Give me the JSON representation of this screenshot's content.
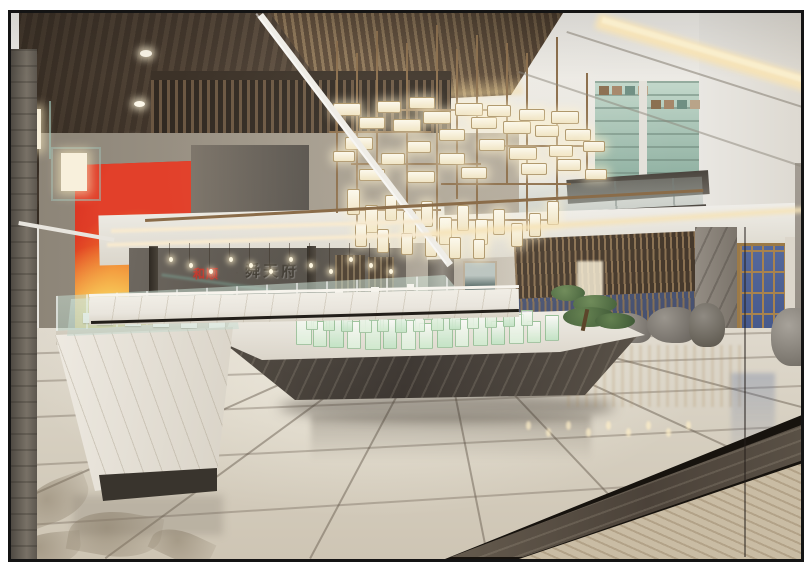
{
  "scene": {
    "type": "interior-architectural-rendering",
    "description": "Double-height real-estate sales center lobby: dark wood ceiling, brass box chandelier, balcony with moon-gate screen, stone reception wall, green glass scale model on a marble island, glass vitrines, red artwork, wooden lattice with blue glass door, glossy marble floor",
    "signage": {
      "red_text": "和顺",
      "separator": "·",
      "metal_text": "舜天府"
    },
    "palette": {
      "frame": "#141414",
      "wood_ceiling": "#54463a",
      "slat_ceiling": "#8a7254",
      "ceiling_white": "#edebe6",
      "cove_light": "#f6e3b8",
      "lamp_glow": "#faf3e0",
      "brass": "#8a6c49",
      "teal_glass": "#9fc3b5",
      "reception_marble": "#5f5952",
      "counter_marble": "#e9e5dd",
      "accent_red": "#c23b2d",
      "poster_red": "#d3261a",
      "poster_gold": "#f4c455",
      "model_glass": "#cfe8cd",
      "bonsai_green": "#5d7a4a",
      "lattice_wood": "#8a7152",
      "door_blue": "#4c5f8f",
      "floor_light": "#d9d2c4",
      "floor_border_dark": "#5a5146",
      "floor_corner_wood": "#c9bca4",
      "rock_grey": "#8b867e"
    },
    "counts": {
      "ceiling_downlights": 3,
      "hanging_bulbs": 12,
      "chandelier_lamps": 48,
      "model_towers": 39
    }
  }
}
